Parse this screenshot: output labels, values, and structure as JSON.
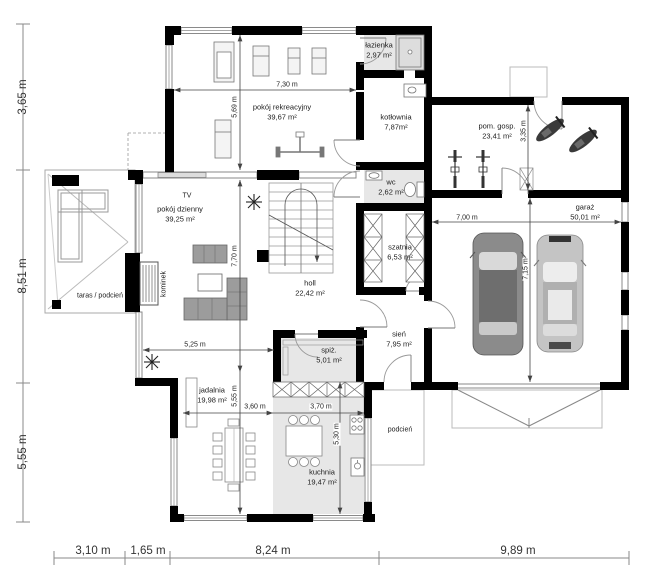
{
  "plan": {
    "type": "house ground-floor plan",
    "colors": {
      "wall": "#000000",
      "tile_floor": "#e7e7e7",
      "thin_line": "#999999",
      "dim_line": "#444444",
      "sofa_gray": "#9c9c9c",
      "car_dark": "#8b8b8b",
      "car_light": "#c4c4c4"
    }
  },
  "rooms": [
    {
      "id": "pokoj-rekreacyjny",
      "name": "pokój rekreacyjny",
      "area": "39,67 m²"
    },
    {
      "id": "lazienka",
      "name": "łazienka",
      "area": "2,97 m²"
    },
    {
      "id": "kotlownia",
      "name": "kotłownia",
      "area": "7,87m²"
    },
    {
      "id": "pom-gosp",
      "name": "pom. gosp.",
      "area": "23,41 m²"
    },
    {
      "id": "garaz",
      "name": "garaż",
      "area": "50,01 m²"
    },
    {
      "id": "pokoj-dzienny",
      "name": "pokój dzienny",
      "area": "39,25 m²"
    },
    {
      "id": "holl",
      "name": "holl",
      "area": "22,42 m²"
    },
    {
      "id": "wc",
      "name": "wc",
      "area": "2,62 m²"
    },
    {
      "id": "szatnia",
      "name": "szatnia",
      "area": "6,53 m²"
    },
    {
      "id": "sien",
      "name": "sień",
      "area": "7,95 m²"
    },
    {
      "id": "spiz",
      "name": "spiż.",
      "area": "5,01 m²"
    },
    {
      "id": "jadalnia",
      "name": "jadalnia",
      "area": "19,98 m²"
    },
    {
      "id": "kuchnia",
      "name": "kuchnia",
      "area": "19,47 m²"
    }
  ],
  "labels": {
    "taras": "taras / podcień",
    "podcien": "podcień",
    "kominek": "kominek",
    "tv": "TV"
  },
  "dims": {
    "left": [
      "3,65 m",
      "8,51 m",
      "5,55 m"
    ],
    "bottom": [
      "3,10 m",
      "1,65 m",
      "8,24 m",
      "9,89 m"
    ],
    "internal": {
      "rec_w": "7,30 m",
      "rec_h": "5,69 m",
      "living_h": "7,70 m",
      "living_w": "5,25 m",
      "dining_h": "5,55 m",
      "dining_w": "3,60 m",
      "kitchen_w": "3,70 m",
      "kitchen_h": "5,30 m",
      "garage_w": "7,00 m",
      "garage_h": "7,15 m",
      "utility_h": "3,35 m"
    }
  }
}
